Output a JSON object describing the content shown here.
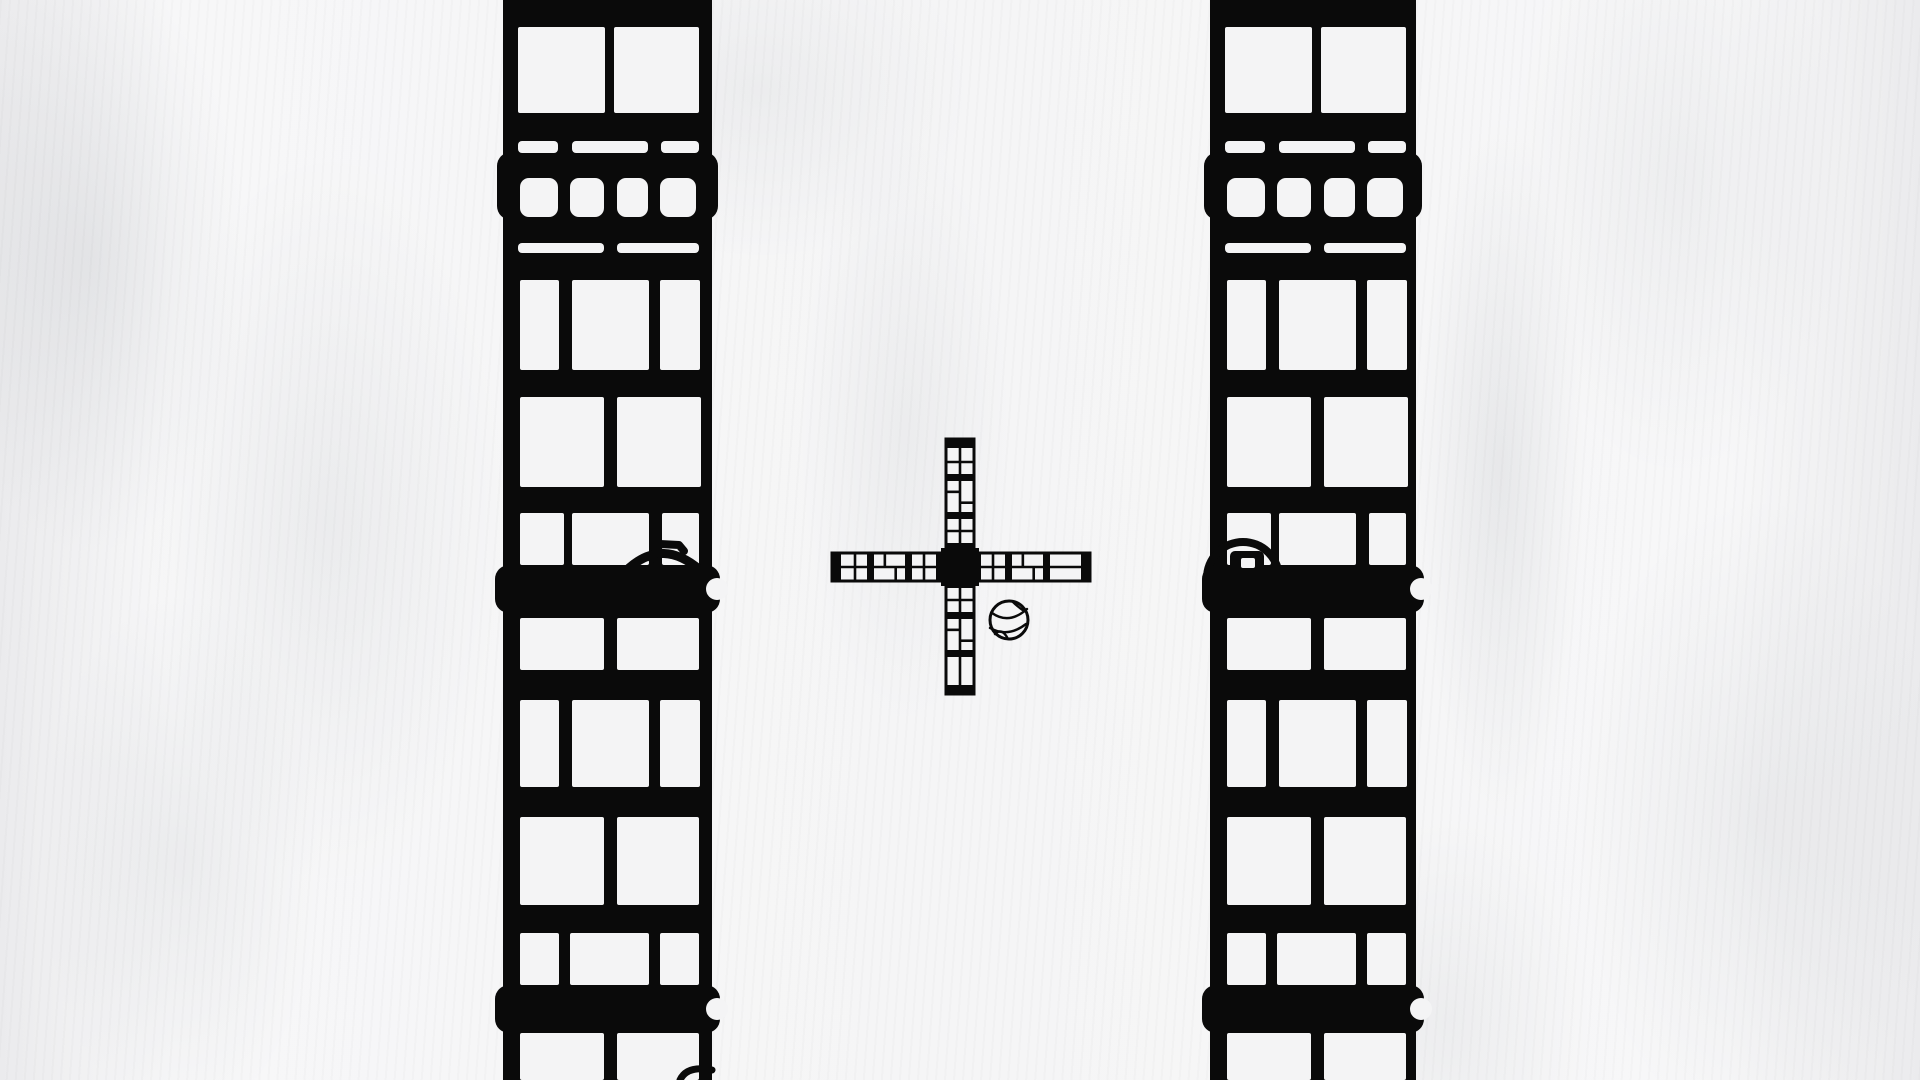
{
  "scene": {
    "width": 1920,
    "height": 1080,
    "colors": {
      "paper": "#f6f6f7",
      "ink": "#0a0a0a",
      "window": "#f4f4f5"
    }
  },
  "towers": {
    "pattern": {
      "crown_ledge": {
        "y": 152,
        "h": 68
      },
      "rows": [
        {
          "name": "big-pair-top",
          "y": 27,
          "h": 86,
          "rx": 2,
          "cells": [
            [
              15,
              102
            ],
            [
              111,
              196
            ]
          ]
        },
        {
          "name": "slits-three",
          "y": 141,
          "h": 12,
          "rx": 4,
          "cells": [
            [
              15,
              55
            ],
            [
              69,
              145
            ],
            [
              158,
              196
            ]
          ]
        },
        {
          "name": "small-four",
          "y": 178,
          "h": 39,
          "rx": 9,
          "cells": [
            [
              17,
              55
            ],
            [
              67,
              101
            ],
            [
              114,
              145
            ],
            [
              157,
              193
            ]
          ]
        },
        {
          "name": "slits-two",
          "y": 243,
          "h": 10,
          "rx": 4,
          "cells": [
            [
              15,
              101
            ],
            [
              114,
              196
            ]
          ]
        },
        {
          "name": "tall-three",
          "y": 280,
          "h": 90,
          "rx": 2,
          "cells": [
            [
              17,
              56
            ],
            [
              69,
              146
            ],
            [
              157,
              197
            ]
          ]
        },
        {
          "name": "big-pair",
          "y": 397,
          "h": 90,
          "rx": 2,
          "cells": [
            [
              17,
              101
            ],
            [
              114,
              198
            ]
          ]
        },
        {
          "name": "short-three",
          "y": 513,
          "h": 52,
          "rx": 2,
          "cells": [
            [
              17,
              61
            ],
            [
              69,
              146
            ],
            [
              159,
              196
            ]
          ]
        },
        {
          "name": "mid-pair",
          "y": 618,
          "h": 52,
          "rx": 2,
          "cells": [
            [
              17,
              101
            ],
            [
              114,
              196
            ]
          ]
        },
        {
          "name": "tall-three-2",
          "y": 700,
          "h": 87,
          "rx": 2,
          "cells": [
            [
              17,
              56
            ],
            [
              69,
              146
            ],
            [
              157,
              197
            ]
          ]
        },
        {
          "name": "big-pair-2",
          "y": 817,
          "h": 88,
          "rx": 2,
          "cells": [
            [
              17,
              101
            ],
            [
              114,
              196
            ]
          ]
        },
        {
          "name": "short-three-2",
          "y": 933,
          "h": 52,
          "rx": 2,
          "cells": [
            [
              17,
              56
            ],
            [
              67,
              146
            ],
            [
              157,
              196
            ]
          ]
        },
        {
          "name": "bottom-pair",
          "y": 1033,
          "h": 47,
          "rx": 2,
          "cells": [
            [
              17,
              101
            ],
            [
              114,
              196
            ]
          ]
        }
      ],
      "ledges": [
        {
          "y": 565,
          "h": 48
        },
        {
          "y": 985,
          "h": 48
        }
      ],
      "ledge_overhang": 8,
      "ledge_corner_radius": 14,
      "notch_radius": 11,
      "notch_offset_y": 24
    },
    "left": {
      "x": 503,
      "width": 209,
      "has_hook": true,
      "has_porthole": false,
      "has_bottom_arc": true
    },
    "right": {
      "x": 1210,
      "width": 206,
      "has_hook": false,
      "has_porthole": true,
      "has_bottom_arc": false
    }
  },
  "hook": {
    "arc_path": "M629 568 Q663 538 700 570",
    "nub_path": "M652 559 L660 544 L679 545 L684 551",
    "stroke": 9
  },
  "bottom_arc": {
    "path": "M680 1080 Q687 1065 712 1070",
    "stroke": 7
  },
  "porthole": {
    "cx": 1243,
    "cy": 578,
    "r": 36,
    "stroke": 8,
    "knob": {
      "x": 1230,
      "y": 551,
      "w": 34,
      "h": 24,
      "rx": 5,
      "inner": {
        "x": 1241,
        "y": 558,
        "w": 14,
        "h": 10,
        "rx": 2
      }
    }
  },
  "windmill": {
    "cx": 960,
    "cy": 567,
    "h_bar": {
      "x": 832,
      "y": 553,
      "len": 258,
      "t": 28
    },
    "v_bar": {
      "x": 946,
      "y": 439,
      "len": 255,
      "t": 28
    },
    "hub_size": 38,
    "cell_a": 24,
    "cell_b": 31,
    "divider": 7,
    "end_cap": 9,
    "outline": 3,
    "joint": 2.6
  },
  "basketball": {
    "cx": 1009,
    "cy": 620,
    "r": 19,
    "outline": 3,
    "seams": [
      "M992 613 Q1009 625 1027 609",
      "M990 628 Q1008 638 1026 624",
      "M995 634 Q1002 627 1008 639",
      "M1013 602 Q1018 607 1024 611"
    ]
  }
}
